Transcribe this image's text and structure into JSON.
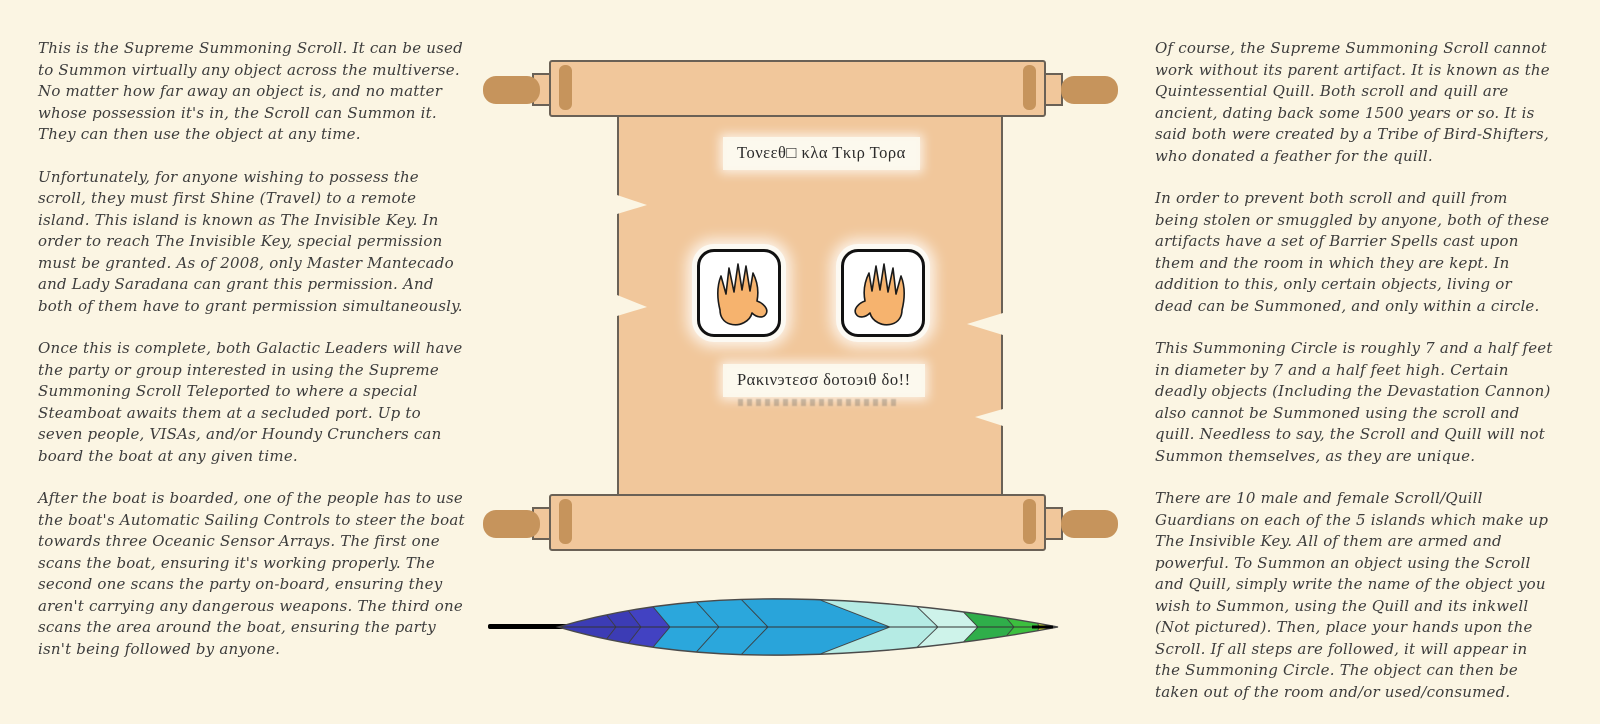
{
  "page": {
    "background": "#fbf5e3"
  },
  "left_column": {
    "paragraphs": [
      "This is the Supreme Summoning Scroll. It can be used to Summon virtually any object across the multiverse. No matter how far away an object is, and no matter whose possession it's in, the Scroll can Summon it. They can then use the object at any time.",
      "Unfortunately, for anyone wishing to possess the scroll, they must first Shine (Travel) to a remote island. This island is known as The Invisible Key. In order to reach The Invisible Key, special permission must be granted. As of 2008, only Master Mantecado and Lady Saradana can grant this permission. And both of them have to grant permission simultaneously.",
      "Once this is complete, both Galactic Leaders will have the party or group interested in using the Supreme Summoning Scroll Teleported to where a special Steamboat awaits them at a secluded port. Up to seven people, VISAs, and/or Houndy Crunchers can board the boat at any given time.",
      "After the boat is boarded, one of the people has to use the boat's Automatic Sailing Controls to steer the boat towards three Oceanic Sensor Arrays. The first one scans the boat, ensuring it's working properly. The second one scans the party on-board, ensuring they aren't carrying any dangerous weapons. The third one scans the area around the boat, ensuring the party isn't being followed by anyone."
    ]
  },
  "right_column": {
    "paragraphs": [
      "Of course, the Supreme Summoning Scroll cannot work without its parent artifact. It is known as the Quintessential Quill. Both scroll and quill are ancient, dating back some 1500 years or so. It is said both were created by a Tribe of Bird-Shifters, who donated a feather for the quill.",
      "In order to prevent both scroll and quill from being stolen or smuggled by anyone, both of these artifacts have a set of Barrier Spells cast upon them and the room in which they are kept. In addition to this, only certain objects, living or dead can be Summoned, and only within a circle.",
      "This Summoning Circle is roughly 7 and a half feet in diameter by 7 and a half feet high. Certain deadly objects (Including the Devastation Cannon) also cannot be Summoned using the scroll and quill. Needless to say, the Scroll and Quill will not Summon themselves, as they are unique.",
      "There are 10 male and female Scroll/Quill Guardians on each of the 5 islands which make up The Insivible Key. All of them are armed and powerful. To Summon an object using the Scroll and Quill, simply write the name of the object you wish to Summon, using the Quill and its inkwell (Not pictured). Then, place your hands upon the Scroll. If all steps are followed, it will appear in the Summoning Circle. The object can then be taken out of the room and/or used/consumed."
    ]
  },
  "scroll": {
    "title_text": "Τονεεθ□ κλα Τκιρ Τορα",
    "incantation_text": "Ρακινэτεσσ δοτοэιθ δο!!",
    "parchment_color": "#f1c79b",
    "handle_color": "#c6945c",
    "outline_color": "#6a6156",
    "plaque_color": "#fcf9ee"
  },
  "hands": {
    "fill": "#f6b36e",
    "box_border": "#111111"
  },
  "feather": {
    "shaft_color": "#000000",
    "outline": "#4a4a4a",
    "bands": [
      "#3c3cb5",
      "#3c3cb5",
      "#4242c2",
      "#2ba7dc",
      "#2ba7dc",
      "#29a4da",
      "#b5ebe4",
      "#cef3ea",
      "#2fae4a",
      "#3cbf3e",
      "#cde035",
      "#eae98a"
    ]
  }
}
